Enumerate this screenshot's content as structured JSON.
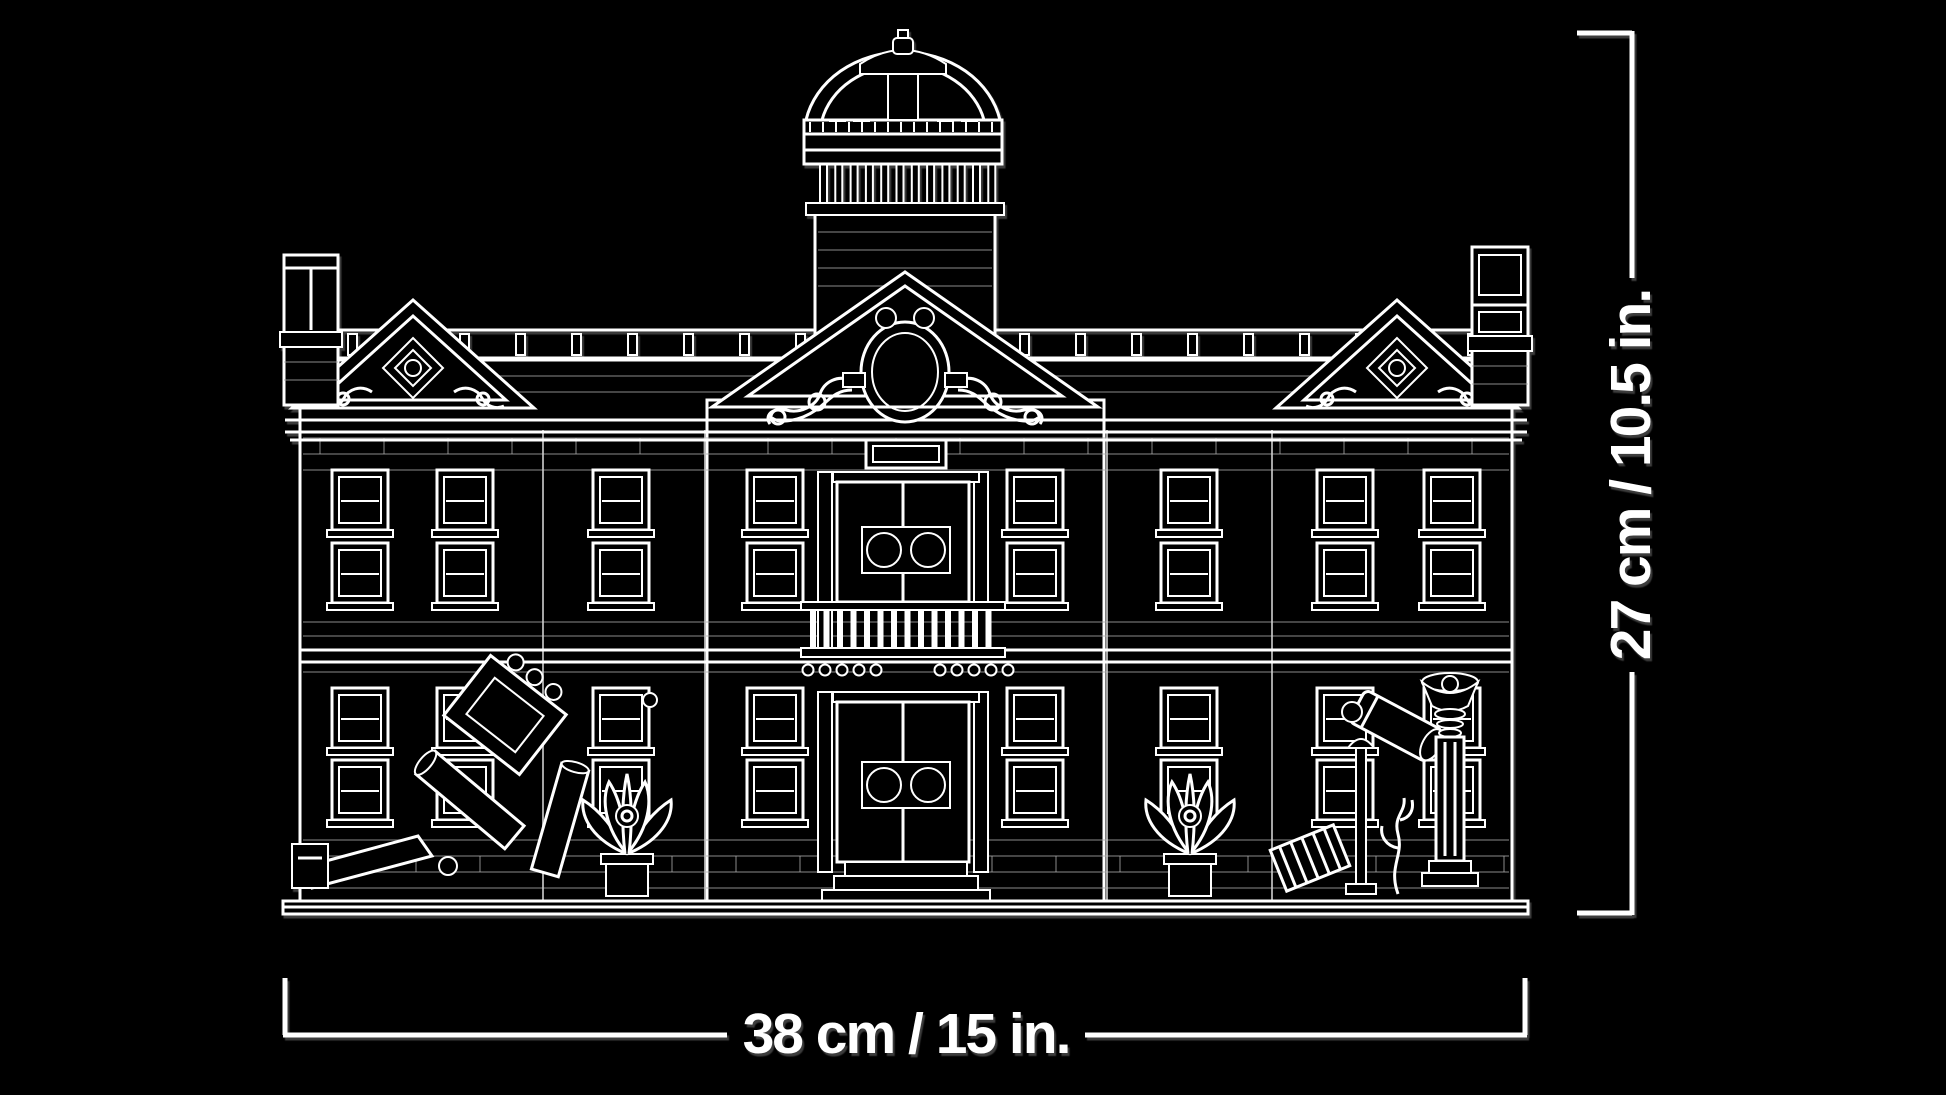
{
  "illustration": {
    "name": "lego-building-facade-line-art",
    "style": "white-outline-on-black",
    "colors": {
      "background": "#000000",
      "line": "#ffffff",
      "dimension_text": "#ffffff"
    },
    "elements": [
      "dome",
      "dome-lantern",
      "drum-colonnade",
      "central-pediment",
      "oculus-window",
      "pediment-scrolls",
      "side-pediment-left",
      "side-pediment-right",
      "chimney-left",
      "chimney-right",
      "roof-balustrade",
      "upper-double-door",
      "lower-double-door",
      "porthole-door-windows",
      "balcony-balustrade",
      "sash-windows",
      "entry-steps",
      "name-plaque",
      "plant-left",
      "plant-right",
      "fallen-frame-debris",
      "fallen-beam",
      "broken-lamp",
      "corrugated-sheet",
      "cactus",
      "broken-column-torch",
      "base-sidewalk"
    ]
  },
  "dimensions": {
    "width_label": "38 cm / 15 in.",
    "height_label": "27 cm / 10.5 in."
  }
}
